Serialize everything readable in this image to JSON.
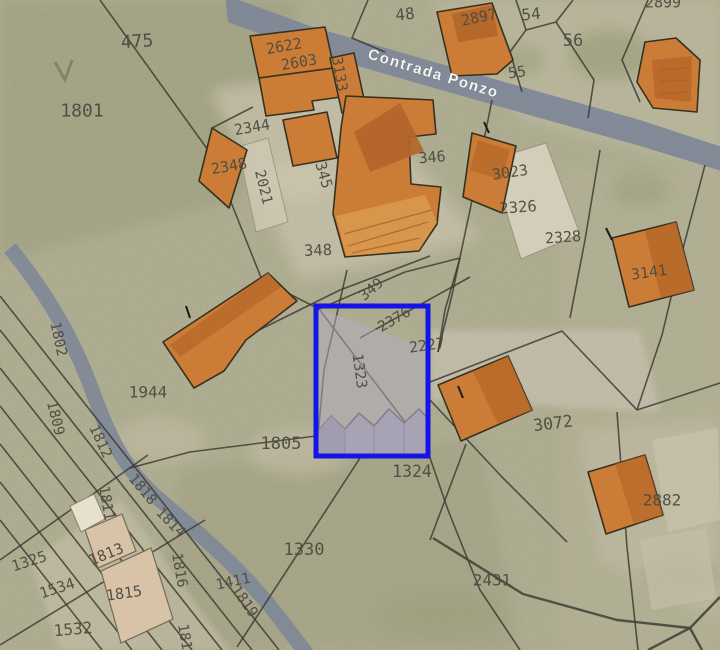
{
  "map": {
    "street_label": "Contrada Ponzo",
    "selection": {
      "parcel": "1323",
      "x": 316,
      "y": 306,
      "width": 112,
      "height": 150,
      "color": "#1414e6"
    },
    "colors": {
      "selection_blue": "#1414e6",
      "building_orange": "#cb7c36",
      "building_orange_shade": "#b2652a",
      "road_gray_blue": "#7e8798",
      "parcel_line": "#3a3830",
      "label_text": "#4d4b40",
      "selected_parcel_fill": "#b3adc2",
      "aerial_base": "#a9a88c"
    },
    "parcel_labels": [
      {
        "t": "475",
        "x": 137,
        "y": 41,
        "r": -4,
        "s": 18
      },
      {
        "t": "1801",
        "x": 82,
        "y": 110,
        "r": 0,
        "s": 18
      },
      {
        "t": "48",
        "x": 405,
        "y": 14,
        "r": -6,
        "s": 16
      },
      {
        "t": "2897",
        "x": 479,
        "y": 17,
        "r": -12,
        "s": 15
      },
      {
        "t": "54",
        "x": 531,
        "y": 14,
        "r": -6,
        "s": 16
      },
      {
        "t": "2899",
        "x": 663,
        "y": 2,
        "r": 0,
        "s": 15
      },
      {
        "t": "55",
        "x": 517,
        "y": 72,
        "r": -8,
        "s": 15
      },
      {
        "t": "56",
        "x": 573,
        "y": 40,
        "r": 0,
        "s": 17
      },
      {
        "t": "2622",
        "x": 284,
        "y": 46,
        "r": -10,
        "s": 15
      },
      {
        "t": "2603",
        "x": 299,
        "y": 62,
        "r": -10,
        "s": 15
      },
      {
        "t": "3133",
        "x": 340,
        "y": 74,
        "r": 80,
        "s": 14.5
      },
      {
        "t": "2344",
        "x": 252,
        "y": 127,
        "r": -10,
        "s": 15
      },
      {
        "t": "2348",
        "x": 229,
        "y": 166,
        "r": -10,
        "s": 15
      },
      {
        "t": "2021",
        "x": 264,
        "y": 187,
        "r": 76,
        "s": 14.5
      },
      {
        "t": "345",
        "x": 324,
        "y": 175,
        "r": 74,
        "s": 15
      },
      {
        "t": "346",
        "x": 432,
        "y": 157,
        "r": -5,
        "s": 15
      },
      {
        "t": "3023",
        "x": 510,
        "y": 172,
        "r": -8,
        "s": 15
      },
      {
        "t": "2326",
        "x": 518,
        "y": 207,
        "r": -4,
        "s": 15.5
      },
      {
        "t": "2328",
        "x": 563,
        "y": 237,
        "r": -4,
        "s": 15
      },
      {
        "t": "3141",
        "x": 649,
        "y": 272,
        "r": -8,
        "s": 15
      },
      {
        "t": "348",
        "x": 318,
        "y": 250,
        "r": -2,
        "s": 15.5
      },
      {
        "t": "349",
        "x": 371,
        "y": 289,
        "r": -40,
        "s": 14.5
      },
      {
        "t": "2376",
        "x": 394,
        "y": 319,
        "r": -30,
        "s": 14.5
      },
      {
        "t": "2227",
        "x": 427,
        "y": 345,
        "r": -8,
        "s": 15
      },
      {
        "t": "1323",
        "x": 360,
        "y": 371,
        "r": 82,
        "s": 14.5
      },
      {
        "t": "1944",
        "x": 148,
        "y": 392,
        "r": 0,
        "s": 16
      },
      {
        "t": "1802",
        "x": 59,
        "y": 339,
        "r": 78,
        "s": 14.5
      },
      {
        "t": "1809",
        "x": 56,
        "y": 418,
        "r": 76,
        "s": 14.5
      },
      {
        "t": "1812",
        "x": 101,
        "y": 441,
        "r": 65,
        "s": 14.5
      },
      {
        "t": "1811",
        "x": 107,
        "y": 503,
        "r": 80,
        "s": 14.5
      },
      {
        "t": "1818",
        "x": 143,
        "y": 489,
        "r": 50,
        "s": 14.5
      },
      {
        "t": "1814",
        "x": 171,
        "y": 522,
        "r": 45,
        "s": 14.5
      },
      {
        "t": "1813",
        "x": 106,
        "y": 554,
        "r": -22,
        "s": 15
      },
      {
        "t": "1325",
        "x": 29,
        "y": 561,
        "r": -18,
        "s": 15
      },
      {
        "t": "1534",
        "x": 57,
        "y": 588,
        "r": -18,
        "s": 15
      },
      {
        "t": "1815",
        "x": 124,
        "y": 593,
        "r": -8,
        "s": 15
      },
      {
        "t": "1816",
        "x": 180,
        "y": 570,
        "r": 80,
        "s": 14.5
      },
      {
        "t": "1532",
        "x": 73,
        "y": 629,
        "r": -5,
        "s": 16
      },
      {
        "t": "1411",
        "x": 233,
        "y": 581,
        "r": -12,
        "s": 14.5
      },
      {
        "t": "1819",
        "x": 245,
        "y": 601,
        "r": 55,
        "s": 14.5
      },
      {
        "t": "1811",
        "x": 186,
        "y": 641,
        "r": 80,
        "s": 14.5
      },
      {
        "t": "1805",
        "x": 281,
        "y": 443,
        "r": 0,
        "s": 17
      },
      {
        "t": "1324",
        "x": 412,
        "y": 471,
        "r": 0,
        "s": 16.5
      },
      {
        "t": "1330",
        "x": 304,
        "y": 549,
        "r": 0,
        "s": 17
      },
      {
        "t": "2431",
        "x": 492,
        "y": 580,
        "r": 0,
        "s": 16
      },
      {
        "t": "3072",
        "x": 553,
        "y": 423,
        "r": -7,
        "s": 16.5
      },
      {
        "t": "2882",
        "x": 662,
        "y": 500,
        "r": 0,
        "s": 16
      }
    ]
  }
}
